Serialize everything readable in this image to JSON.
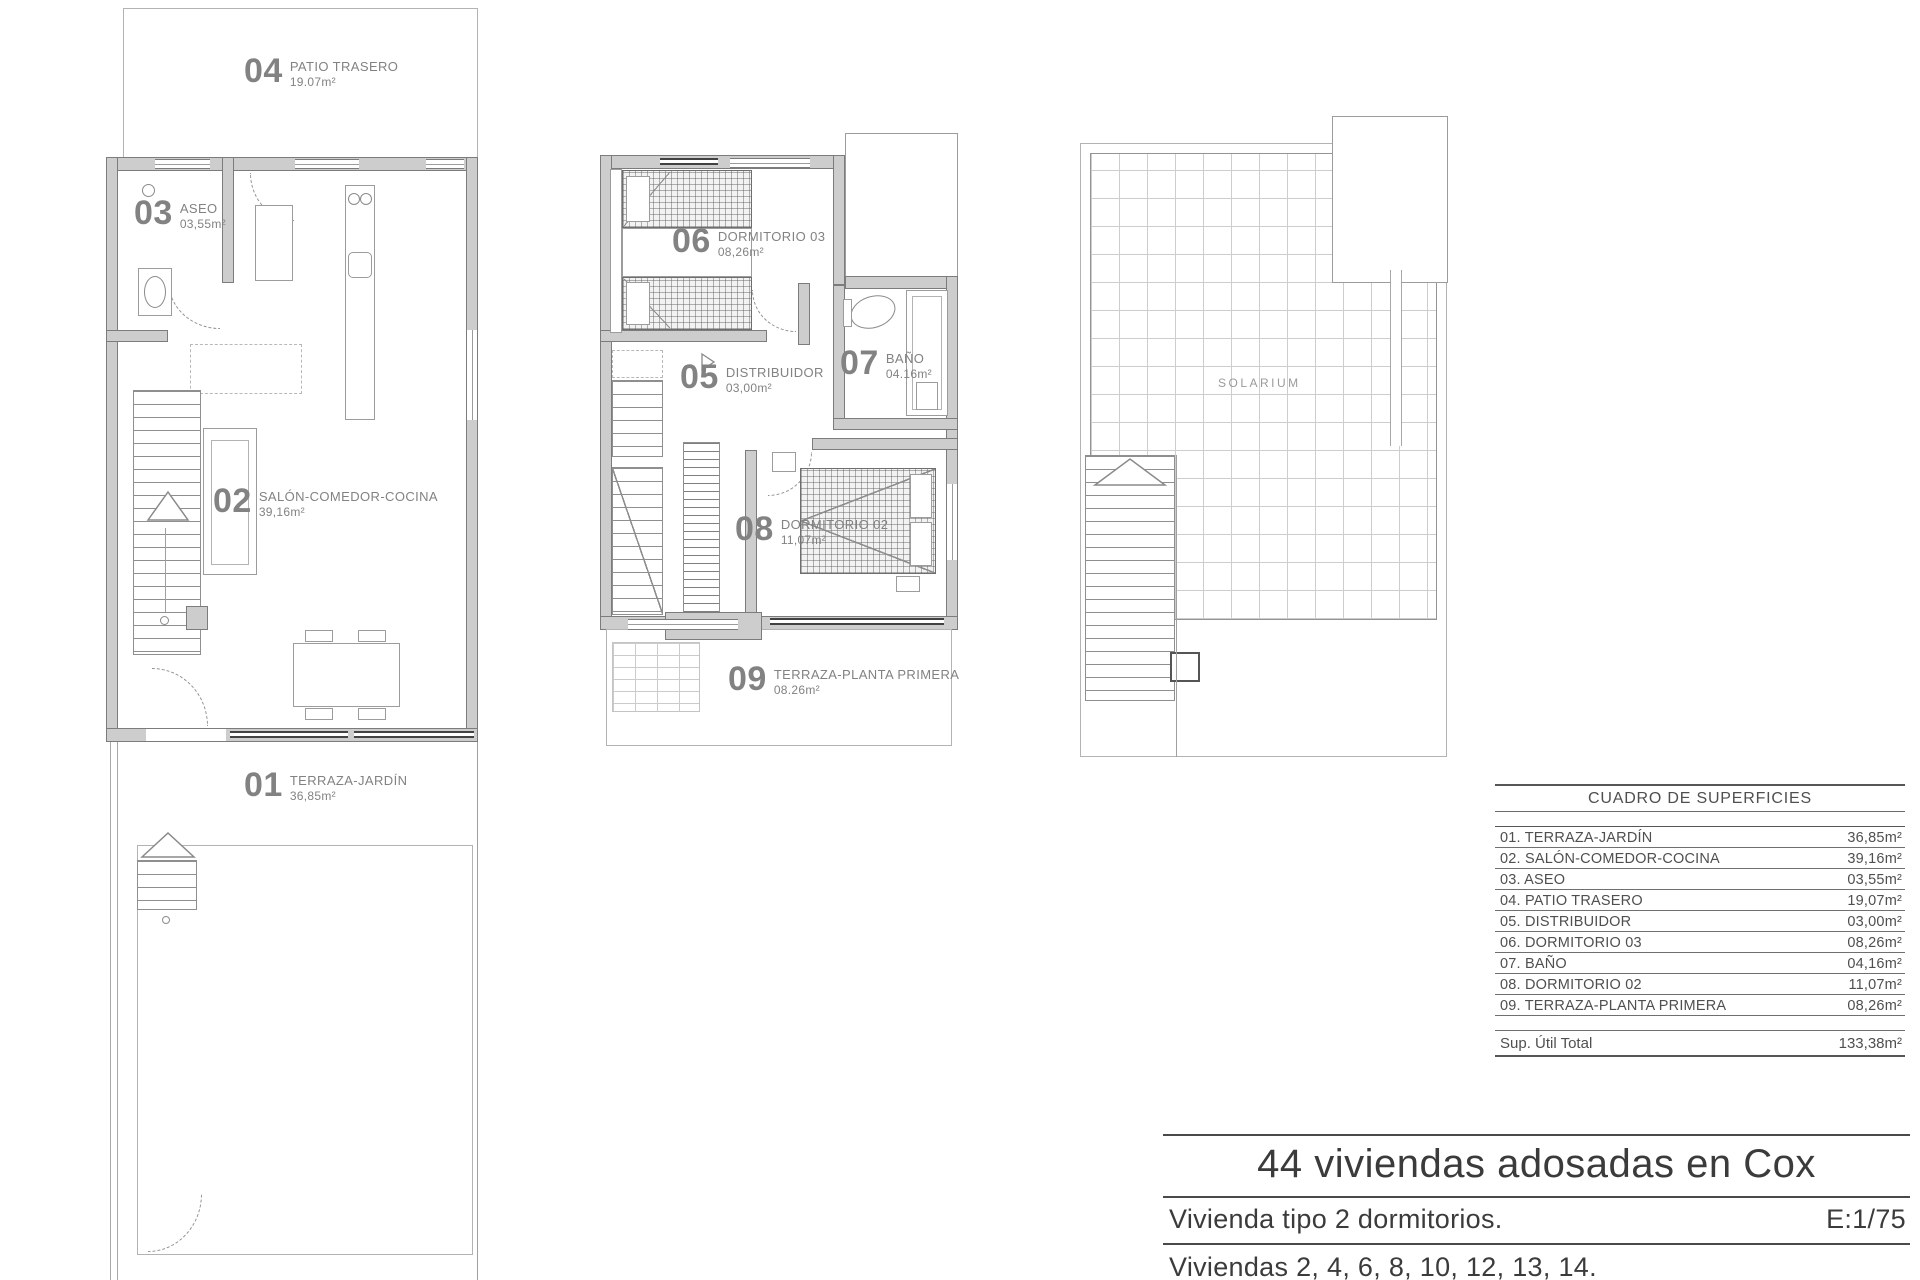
{
  "sheet": {
    "plans": {
      "ground": {
        "rooms": [
          {
            "num": "04",
            "name": "PATIO TRASERO",
            "area": "19.07m²"
          },
          {
            "num": "03",
            "name": "ASEO",
            "area": "03,55m²"
          },
          {
            "num": "02",
            "name": "SALÓN-COMEDOR-COCINA",
            "area": "39,16m²"
          },
          {
            "num": "01",
            "name": "TERRAZA-JARDÍN",
            "area": "36,85m²"
          }
        ]
      },
      "first": {
        "rooms": [
          {
            "num": "06",
            "name": "DORMITORIO 03",
            "area": "08,26m²"
          },
          {
            "num": "05",
            "name": "DISTRIBUIDOR",
            "area": "03,00m²"
          },
          {
            "num": "07",
            "name": "BAÑO",
            "area": "04.16m²"
          },
          {
            "num": "08",
            "name": "DORMITORIO 02",
            "area": "11,07m²"
          },
          {
            "num": "09",
            "name": "TERRAZA-PLANTA PRIMERA",
            "area": "08.26m²"
          }
        ]
      },
      "roof": {
        "label": "SOLARIUM"
      }
    },
    "surfaces_table": {
      "title": "CUADRO DE SUPERFICIES",
      "rows": [
        {
          "label": "01. TERRAZA-JARDÍN",
          "value": "36,85m²"
        },
        {
          "label": "02. SALÓN-COMEDOR-COCINA",
          "value": "39,16m²"
        },
        {
          "label": "03. ASEO",
          "value": "03,55m²"
        },
        {
          "label": "04. PATIO TRASERO",
          "value": "19,07m²"
        },
        {
          "label": "05. DISTRIBUIDOR",
          "value": "03,00m²"
        },
        {
          "label": "06. DORMITORIO 03",
          "value": "08,26m²"
        },
        {
          "label": "07. BAÑO",
          "value": "04,16m²"
        },
        {
          "label": "08. DORMITORIO 02",
          "value": "11,07m²"
        },
        {
          "label": "09. TERRAZA-PLANTA PRIMERA",
          "value": "08,26m²"
        }
      ],
      "total": {
        "label": "Sup. Útil Total",
        "value": "133,38m²"
      }
    },
    "title_block": {
      "project": "44 viviendas adosadas en Cox",
      "dwelling_type": "Vivienda tipo 2 dormitorios.",
      "scale": "E:1/75",
      "units_list": "Viviendas 2, 4, 6, 8, 10, 12, 13, 14."
    },
    "colors": {
      "line": "#8f8f8f",
      "wall_fill": "#cdcdcd",
      "text": "#4f4f4f",
      "label": "#828282"
    }
  }
}
